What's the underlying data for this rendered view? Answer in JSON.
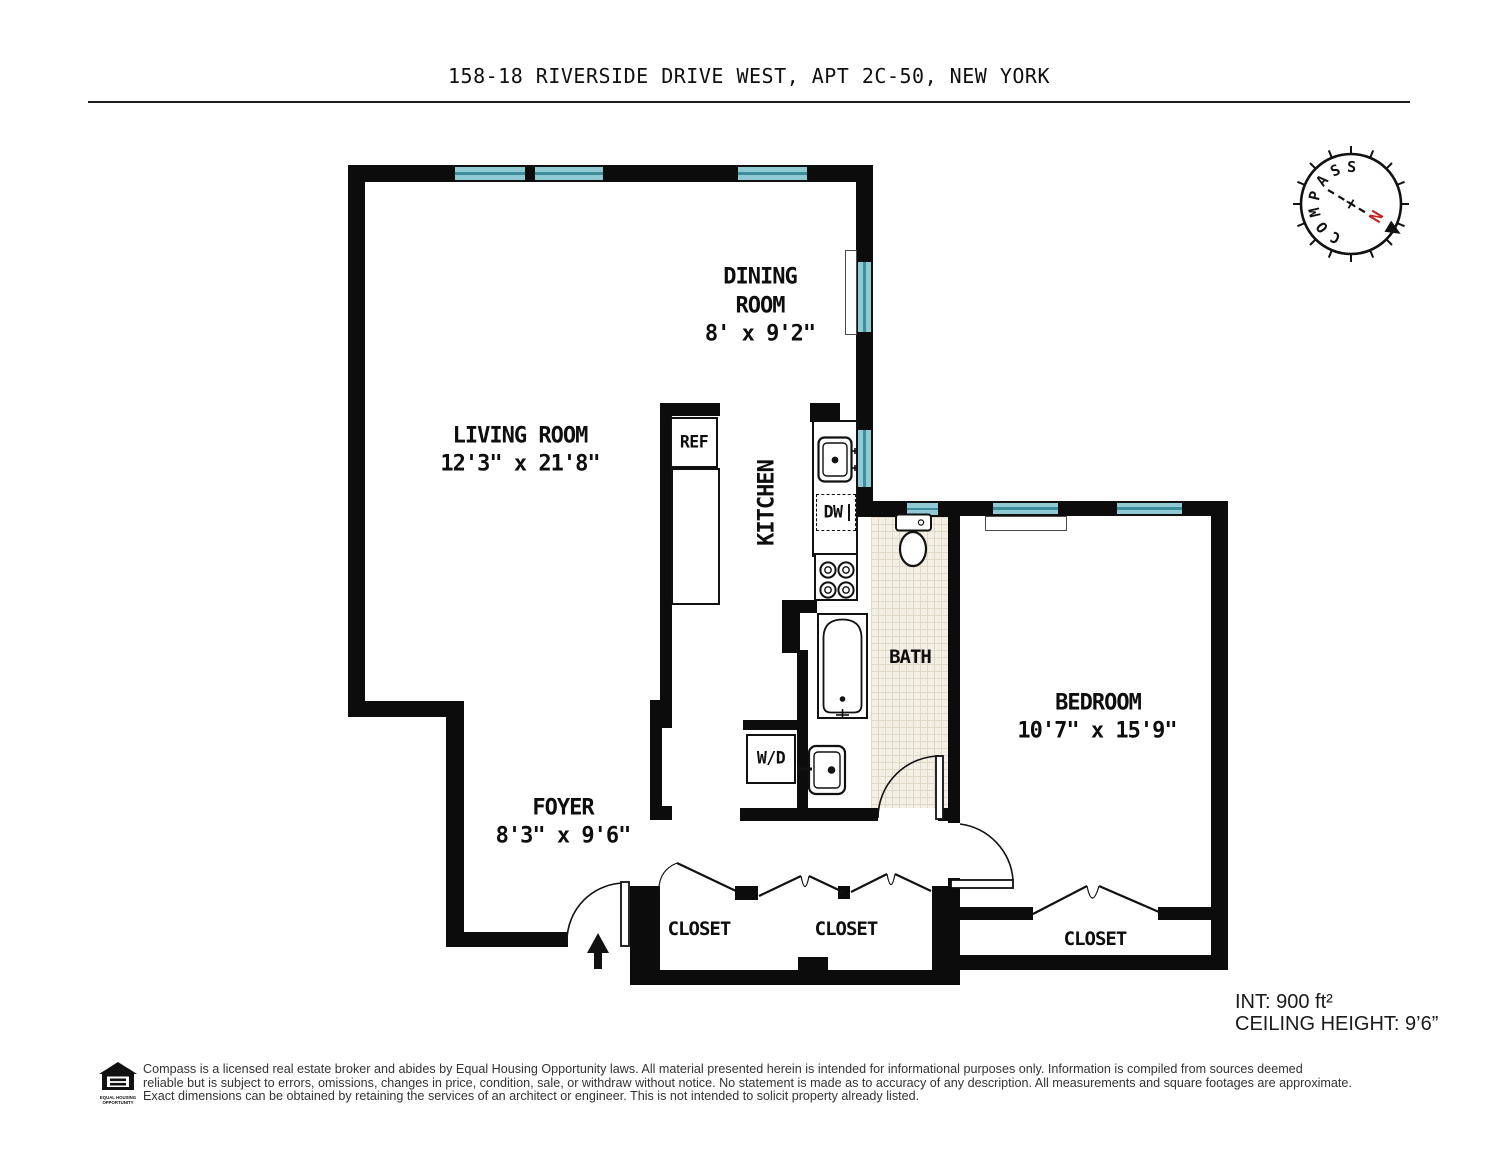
{
  "title": "158-18 RIVERSIDE DRIVE WEST, APT 2C-50, NEW YORK",
  "compass": {
    "label": "COMPASS",
    "north": "N"
  },
  "rooms": {
    "dining": {
      "name_line1": "DINING",
      "name_line2": "ROOM",
      "dims": "8' x 9'2\""
    },
    "living": {
      "name": "LIVING ROOM",
      "dims": "12'3\" x 21'8\""
    },
    "kitchen": {
      "name": "KITCHEN"
    },
    "bath": {
      "name": "BATH"
    },
    "bedroom": {
      "name": "BEDROOM",
      "dims": "10'7\" x 15'9\""
    },
    "foyer": {
      "name": "FOYER",
      "dims": "8'3\" x 9'6\""
    },
    "closet1": {
      "name": "CLOSET"
    },
    "closet2": {
      "name": "CLOSET"
    },
    "closet3": {
      "name": "CLOSET"
    }
  },
  "fixtures": {
    "ref": "REF",
    "dw": "DW",
    "wd": "W/D"
  },
  "info": {
    "interior": "INT: 900 ft²",
    "ceiling": "CEILING HEIGHT: 9’6”"
  },
  "footer": {
    "logo_line1": "EQUAL HOUSING",
    "logo_line2": "OPPORTUNITY",
    "line1": "Compass is a licensed real estate broker and abides by Equal Housing Opportunity laws. All material presented herein is intended for informational purposes only. Information is compiled from sources deemed",
    "line2": "reliable but is subject to errors, omissions, changes in price, condition, sale, or withdraw without notice. No statement is made as to accuracy of any description. All measurements and square footages are approximate.",
    "line3": "Exact dimensions can be obtained by retaining the services of an architect or engineer. This is not intended to solicit property already listed."
  },
  "colors": {
    "wall": "#0c0c0c",
    "window": "#8fc9d2",
    "windowline": "#3d8d9b",
    "tilebg": "#f4efe4",
    "tileline": "#e1d9c7",
    "north": "#c42626"
  }
}
